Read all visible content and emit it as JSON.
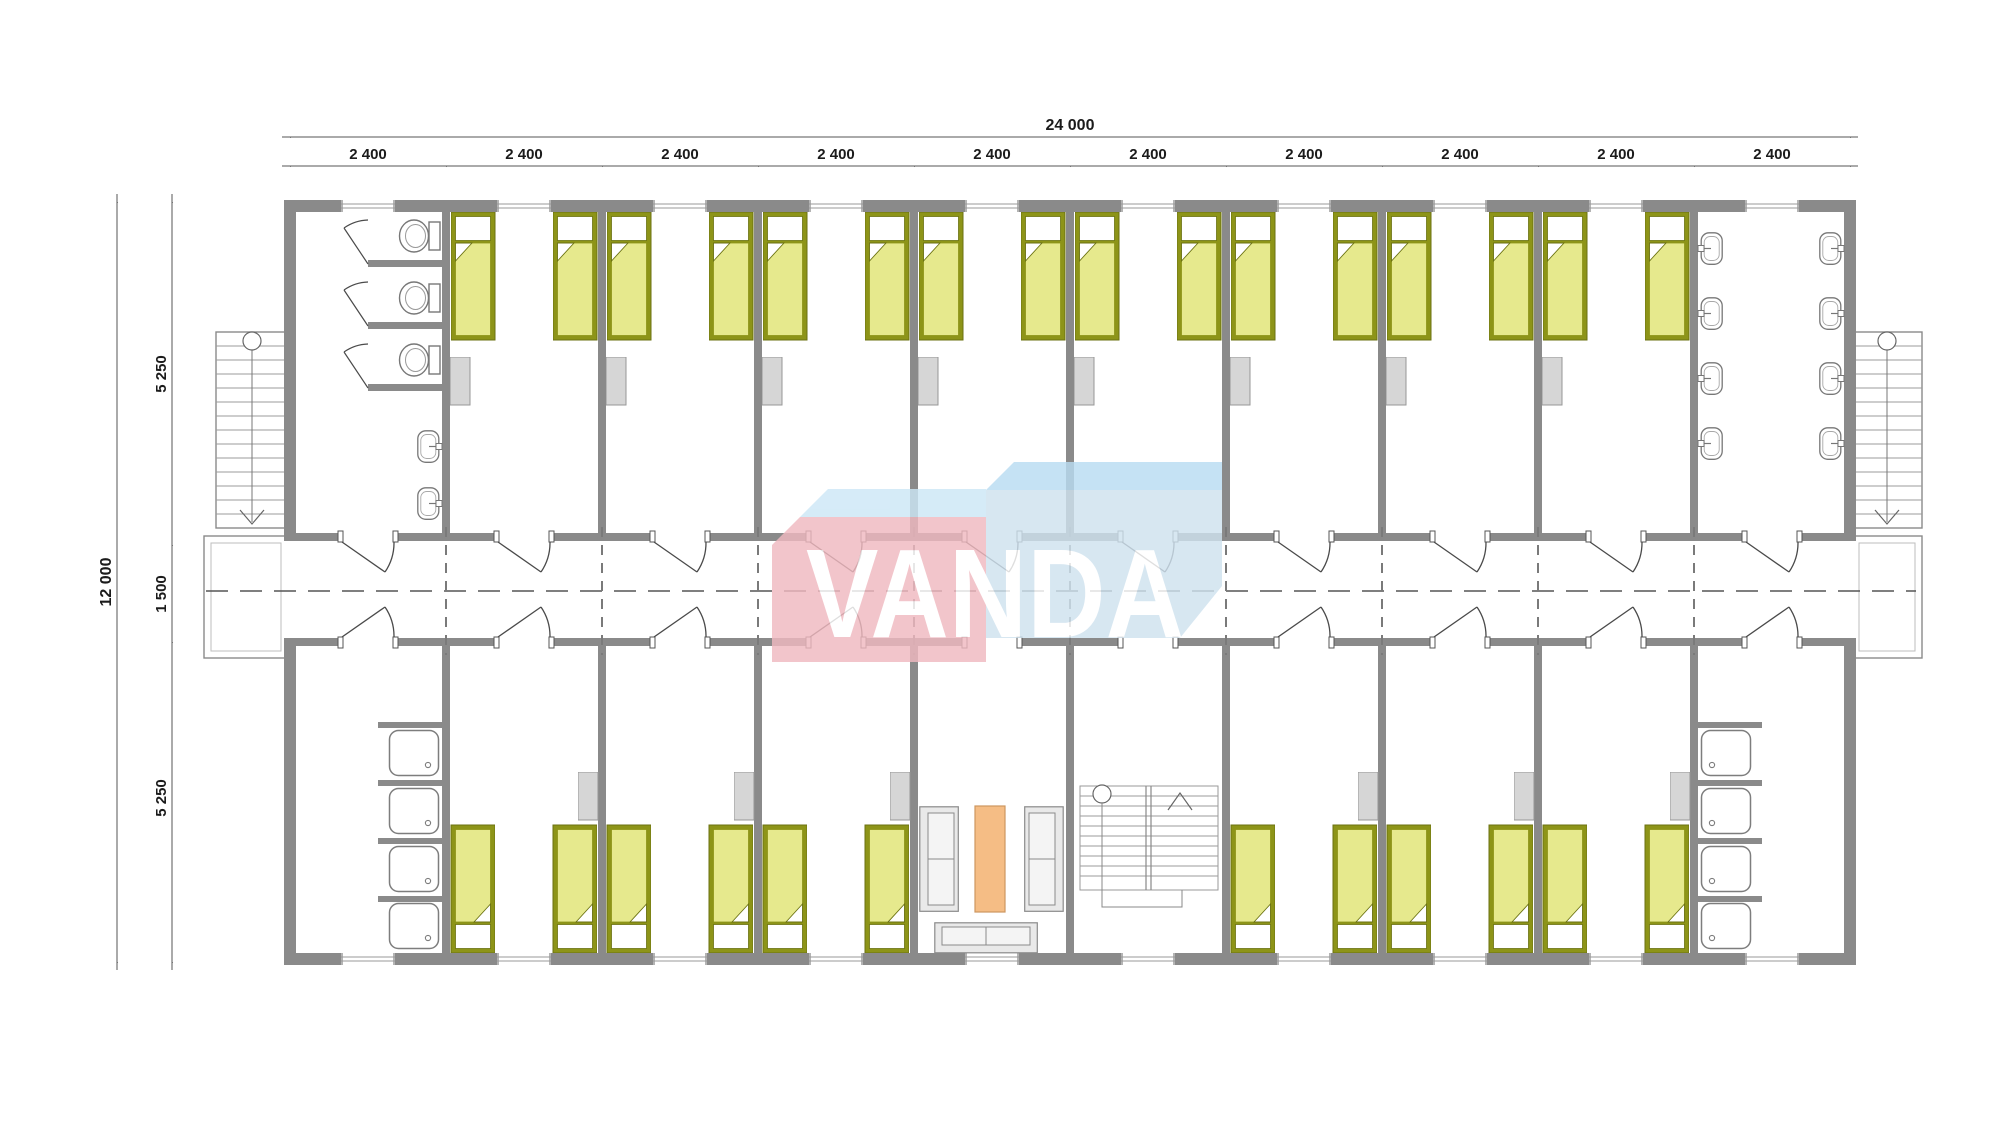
{
  "dimensions": {
    "top": {
      "total": "24 000",
      "segments": [
        "2 400",
        "2 400",
        "2 400",
        "2 400",
        "2 400",
        "2 400",
        "2 400",
        "2 400",
        "2 400",
        "2 400"
      ]
    },
    "left": {
      "total": "12 000",
      "segments": [
        "5 250",
        "1 500",
        "5 250"
      ]
    }
  },
  "logo": {
    "text": "VANDA",
    "front_left_color": "#f0b9c0",
    "front_right_color": "#cfe2ef",
    "top_left_color": "#cde7f6",
    "top_right_color": "#b9dcf2",
    "text_color": "#ffffff"
  },
  "plan": {
    "wall_color": "#8a8a8a",
    "bed_frame_color": "#8d9418",
    "bed_blanket_color": "#e6e98d",
    "bed_pillow_color": "#ffffff",
    "coffee_table_color": "#f5bd85",
    "furniture_color": "#d6d6d6",
    "inventory": {
      "modules_per_row": 10,
      "beds_top_row": 16,
      "beds_bottom_row": 12,
      "wardrobes": 14,
      "toilet_stalls": 3,
      "wc_sinks": 2,
      "washroom_sinks": 8,
      "showers": 8,
      "sofas": 3,
      "coffee_tables": 1,
      "external_stairs": 2,
      "internal_stairs": 1
    }
  }
}
